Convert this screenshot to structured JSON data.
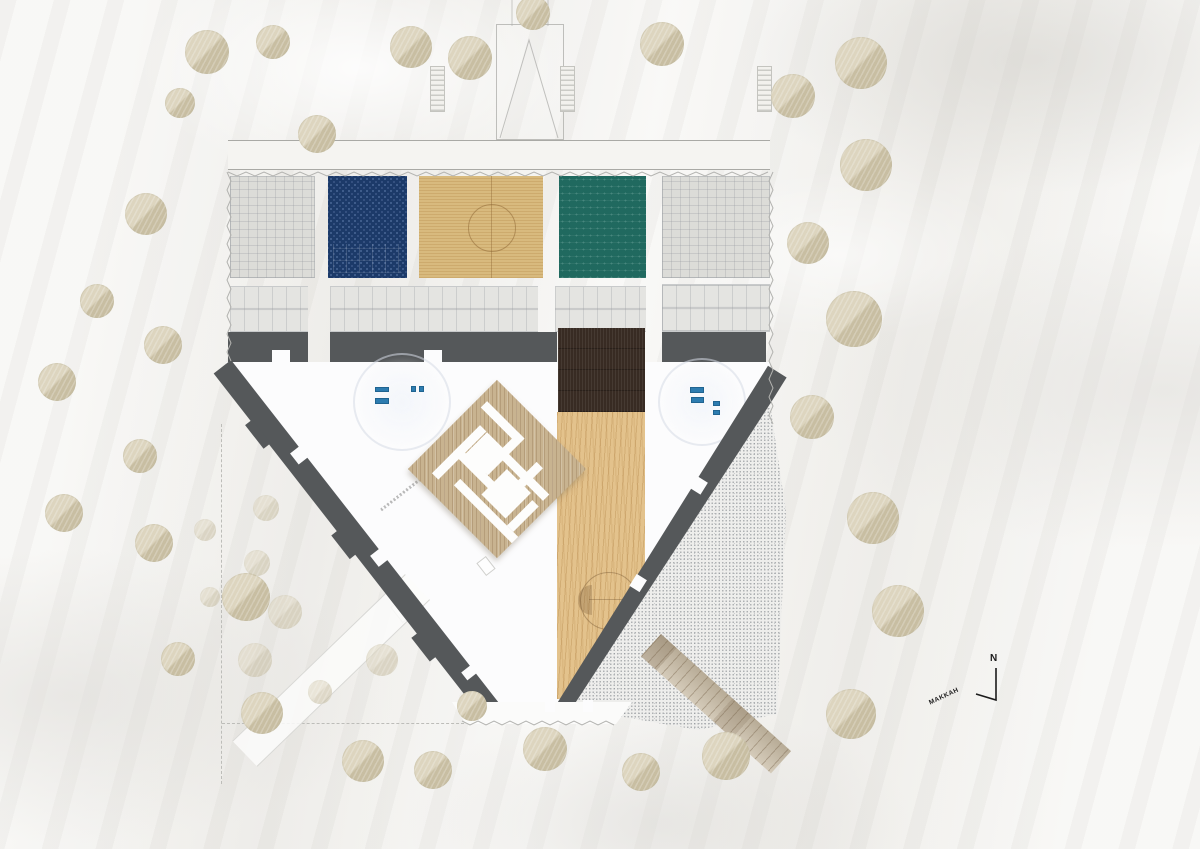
{
  "compass": {
    "north_label": "N",
    "direction_label": "MAKKAH"
  },
  "colors": {
    "bg": "#f0efeb",
    "zone_gray": "#dcdcd8",
    "zone_navy": "#1c3a69",
    "zone_wood": "#d8ba7e",
    "zone_teal": "#20695f",
    "corridor": "#e4e4e1",
    "wall_dark": "#55585a",
    "wood_dark": "#382b23",
    "sand": "#e3c28c",
    "maze_wood": "#c8b390",
    "stipple_base": "#eeeeec",
    "bridge": "#c7baa3",
    "tree_light": "#ddd5bf",
    "tree_dark": "#c8bea2",
    "furniture_blue": "#2d7cb0",
    "line": "#b3b3b0",
    "ink": "#1c1c1c"
  },
  "plan": {
    "zones": [
      {
        "id": "room-plan-left",
        "style": "z-gray",
        "x": 230,
        "w": 85
      },
      {
        "id": "room-blue",
        "style": "z-navy",
        "x": 328,
        "w": 79
      },
      {
        "id": "room-wood-court",
        "style": "z-wood",
        "x": 419,
        "w": 124
      },
      {
        "id": "room-teal",
        "style": "z-teal",
        "x": 559,
        "w": 87
      },
      {
        "id": "room-plan-right",
        "style": "z-gray",
        "x": 662,
        "w": 108
      }
    ]
  },
  "trees": [
    [
      207,
      52,
      22,
      0
    ],
    [
      273,
      42,
      17,
      0
    ],
    [
      180,
      103,
      15,
      0
    ],
    [
      317,
      134,
      19,
      0
    ],
    [
      411,
      47,
      21,
      0
    ],
    [
      470,
      58,
      22,
      0
    ],
    [
      533,
      13,
      17,
      0
    ],
    [
      662,
      44,
      22,
      0
    ],
    [
      793,
      96,
      22,
      0
    ],
    [
      861,
      63,
      26,
      0
    ],
    [
      866,
      165,
      26,
      0
    ],
    [
      808,
      243,
      21,
      0
    ],
    [
      854,
      319,
      28,
      0
    ],
    [
      812,
      417,
      22,
      0
    ],
    [
      873,
      518,
      26,
      0
    ],
    [
      898,
      611,
      26,
      0
    ],
    [
      851,
      714,
      25,
      0
    ],
    [
      146,
      214,
      21,
      0
    ],
    [
      97,
      301,
      17,
      0
    ],
    [
      163,
      345,
      19,
      0
    ],
    [
      57,
      382,
      19,
      0
    ],
    [
      140,
      456,
      17,
      0
    ],
    [
      64,
      513,
      19,
      0
    ],
    [
      154,
      543,
      19,
      0
    ],
    [
      246,
      597,
      24,
      0
    ],
    [
      178,
      659,
      17,
      0
    ],
    [
      262,
      713,
      21,
      0
    ],
    [
      363,
      761,
      21,
      0
    ],
    [
      433,
      770,
      19,
      0
    ],
    [
      545,
      749,
      22,
      0
    ],
    [
      641,
      772,
      19,
      0
    ],
    [
      726,
      756,
      24,
      0
    ],
    [
      472,
      706,
      15,
      0
    ],
    [
      266,
      508,
      13,
      1
    ],
    [
      205,
      530,
      11,
      1
    ],
    [
      257,
      563,
      13,
      1
    ],
    [
      285,
      612,
      17,
      1
    ],
    [
      255,
      660,
      17,
      1
    ],
    [
      382,
      660,
      16,
      1
    ],
    [
      320,
      692,
      12,
      1
    ],
    [
      210,
      597,
      10,
      1
    ]
  ]
}
